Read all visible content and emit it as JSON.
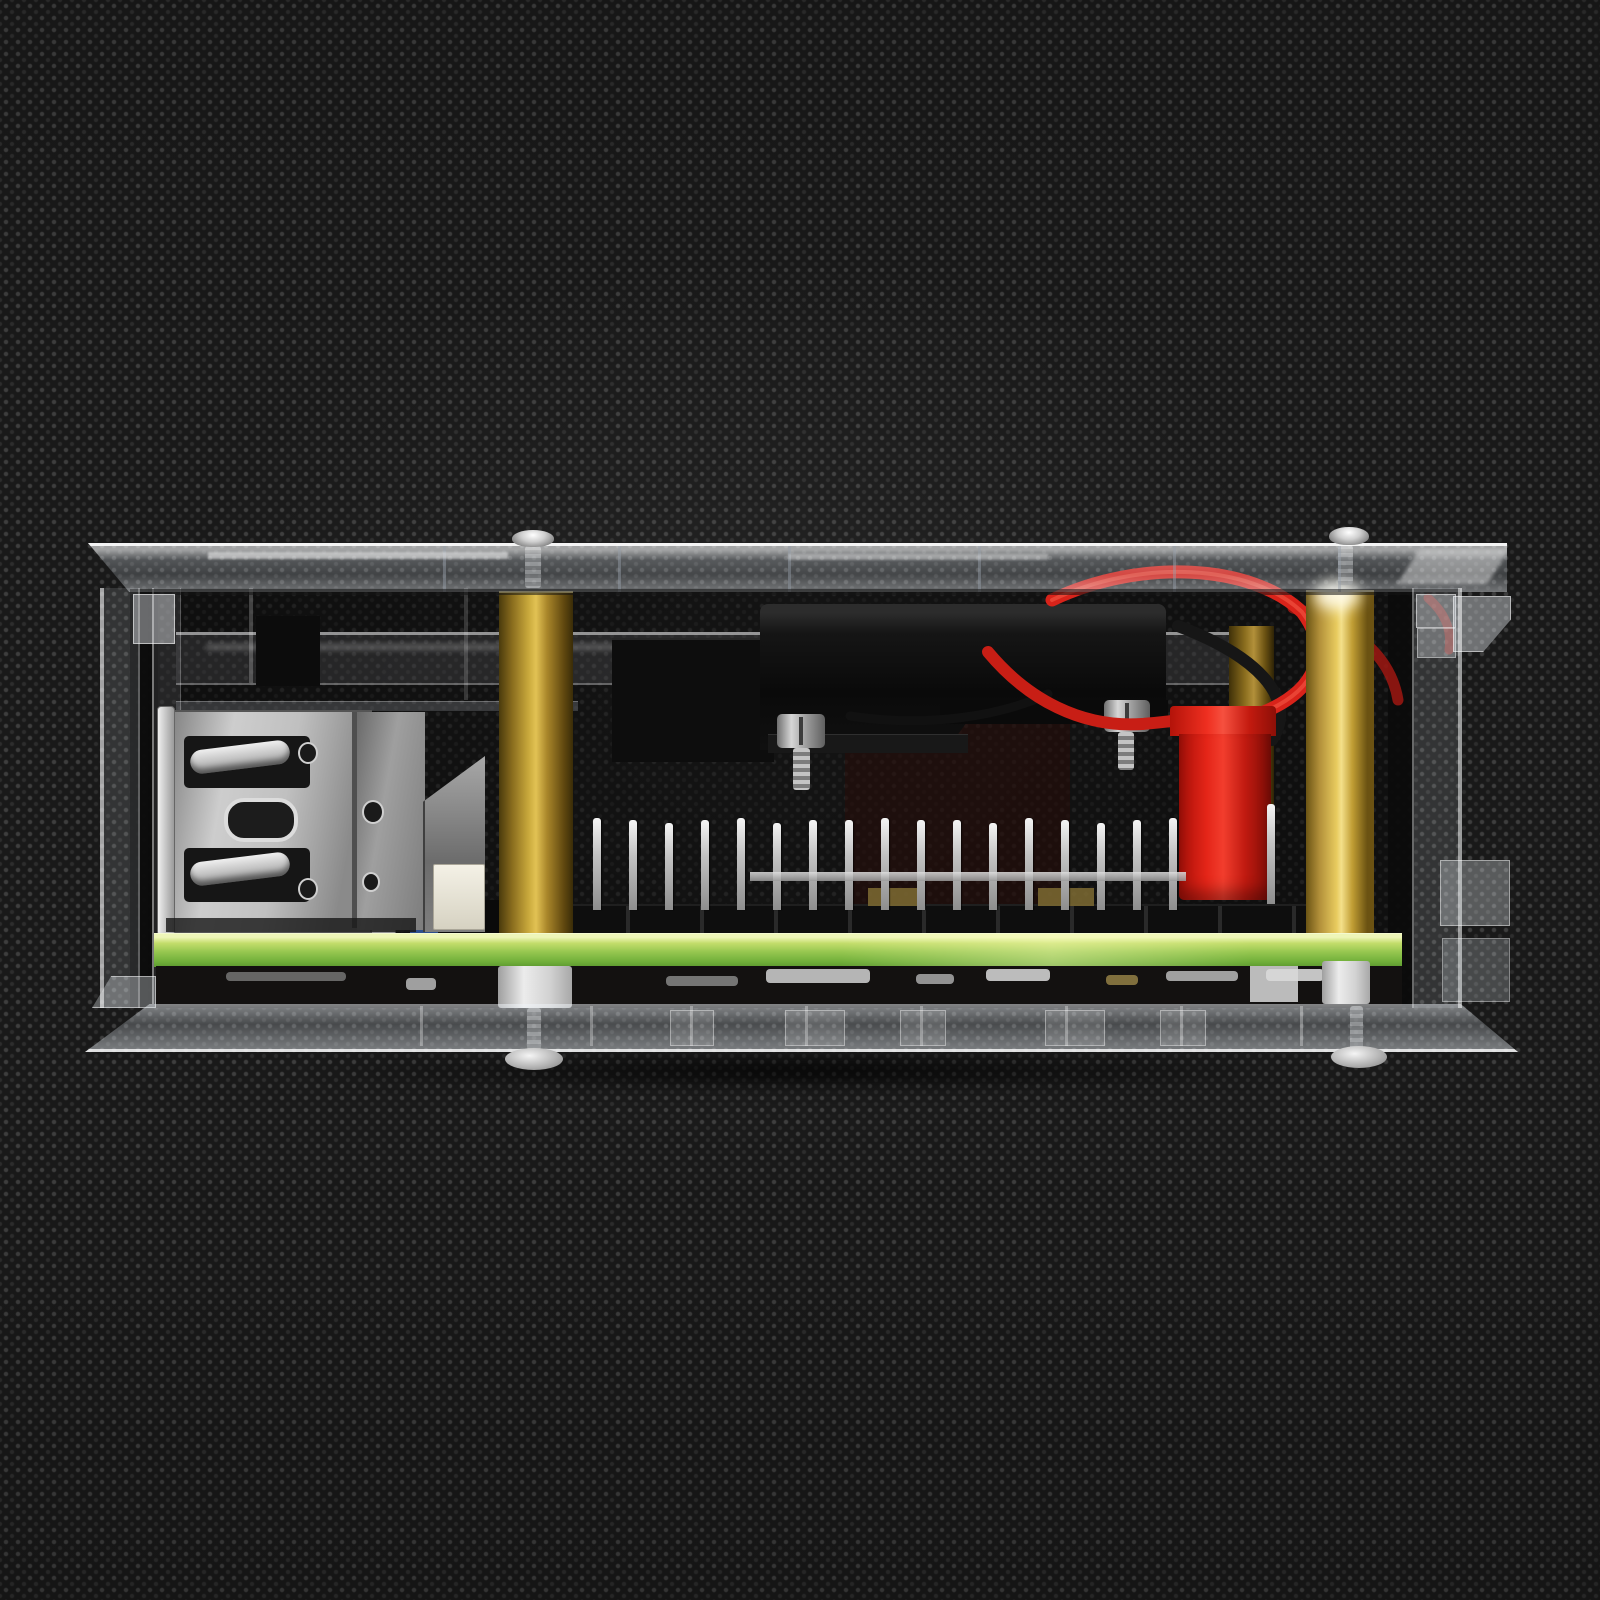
{
  "meta": {
    "domain": "Natural-Image",
    "subject": "Raspberry Pi single-board computer with cooling fan mounted inside a clear acrylic case, side profile view",
    "background": "black non-woven fabric with regular dotted weave texture"
  },
  "palette": {
    "background_base": "#191919",
    "background_dot": "#4a4a4a",
    "acrylic_edge": "#f5f8fa",
    "brass_light": "#e8cb5e",
    "brass_mid": "#b2903a",
    "brass_dark": "#5f470f",
    "pcb_green": "#95c64f",
    "pcb_green_light": "#cde47a",
    "red_plastic": "#ef2f20",
    "wire_red": "#d8231a",
    "wire_black": "#161616",
    "metal_light": "#e8e8e8",
    "metal_mid": "#b9b9b9",
    "metal_dark": "#6f6f6f",
    "fan_black": "#0e0e0e",
    "spacer_white": "#e6e6e6"
  },
  "components": {
    "background_fabric": {
      "label": "black dotted fabric backdrop"
    },
    "case_top_plate": {
      "label": "clear acrylic top plate"
    },
    "case_bottom_plate": {
      "label": "clear acrylic bottom plate"
    },
    "case_left_panel": {
      "label": "clear acrylic side panel, left"
    },
    "case_right_panel": {
      "label": "clear acrylic side panel, right"
    },
    "top_screw_left": {
      "label": "case screw, top left"
    },
    "top_screw_right": {
      "label": "case screw, top right"
    },
    "bottom_screw_left": {
      "label": "countersunk case screw, bottom left"
    },
    "bottom_screw_right": {
      "label": "countersunk case screw, bottom right"
    },
    "standoff_left": {
      "label": "brass hex standoff, left"
    },
    "standoff_right": {
      "label": "brass hex standoff, right"
    },
    "standoff_rear": {
      "label": "brass hex standoff, rear"
    },
    "fan": {
      "label": "black cooling fan"
    },
    "fan_screw_left": {
      "label": "fan mounting screw, left"
    },
    "fan_screw_right": {
      "label": "fan mounting screw, right"
    },
    "wires": {
      "label": "red and black fan power wires"
    },
    "power_connector": {
      "label": "red JST power connector"
    },
    "gpio": {
      "label": "GPIO pin header",
      "pin_count": 17,
      "extra_pin_count": 1,
      "pin_spacing": 36,
      "pin_width": 8,
      "pin_height": 90
    },
    "usb_port": {
      "label": "stacked dual USB-A port, side view"
    },
    "ethernet_port": {
      "label": "ethernet port shield"
    },
    "micro_usb": {
      "label": "micro-USB port"
    },
    "blue_component": {
      "label": "small blue component"
    },
    "white_component": {
      "label": "ivory plastic component"
    },
    "pcb": {
      "label": "green PCB edge"
    },
    "pcb_underside": {
      "label": "PCB underside with solder joints"
    },
    "spacer_left": {
      "label": "nylon spacer, left"
    },
    "spacer_right": {
      "label": "nylon spacer, right"
    }
  }
}
